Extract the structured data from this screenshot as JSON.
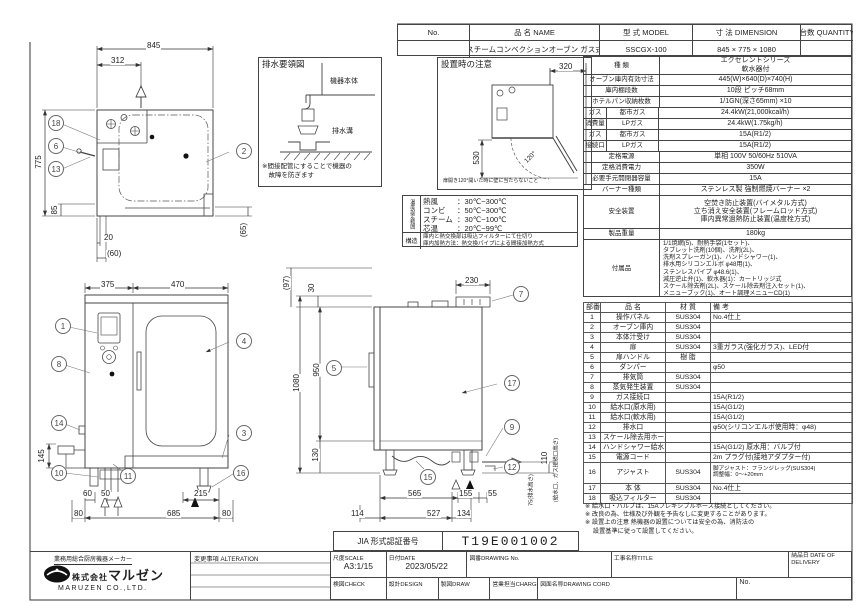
{
  "title_table": {
    "no_h": "No.",
    "name_h": "品 名 NAME",
    "model_h": "型 式 MODEL",
    "dim_h": "寸 法 DIMENSION",
    "qty_h": "台数 QUANTITY",
    "name": "スチームコンベクションオーブン ガス式",
    "model": "SSCGX-100",
    "dimension": "845 × 775 × 1080"
  },
  "spec": {
    "kind": {
      "label": "種  類",
      "v1": "エクセレントシリーズ",
      "v2": "軟水器付"
    },
    "cavity": {
      "label": "オーブン庫内有効寸法",
      "v": "445(W)×640(D)×740(H)"
    },
    "shelf": {
      "label": "庫内棚段数",
      "v": "10段 ピッチ68mm"
    },
    "pan": {
      "label": "ホテルパン収納枚数",
      "v": "1/1GN(深さ65mm) ×10"
    },
    "gasuse": {
      "a": "ガス",
      "b": "消費量",
      "city": "都市ガス",
      "lp": "LPガス",
      "city_v": "24.4kW(21,000kcal/h)",
      "lp_v": "24.4kW(1.75kg/h)"
    },
    "gascon": {
      "a": "ガス",
      "b": "接続口",
      "city": "都市ガス",
      "lp": "LPガス",
      "city_v": "15A(R1/2)",
      "lp_v": "15A(R1/2)"
    },
    "power": {
      "label": "定格電源",
      "v": "単相 100V 50/60Hz 510VA"
    },
    "watt": {
      "label": "定格消費電力",
      "v": "350W"
    },
    "breaker": {
      "label": "必要手元開閉器容量",
      "v": "15A"
    },
    "burner": {
      "label": "バーナー種類",
      "v": "ステンレス製 強制燃焼バーナー ×2"
    },
    "safety": {
      "label": "安全装置",
      "l1": "空焚き防止装置(バイメタル方式)",
      "l2": "立ち消え安全装置(フレームロッド方式)",
      "l3": "庫内異常過熱防止装置(温度栓方式)"
    },
    "weight": {
      "label": "製品重量",
      "v": "180kg"
    },
    "acc": {
      "label": "付属品",
      "lines": [
        "1/1焼網(5)、耐熱手袋(1セット)、",
        "タブレット洗剤(10個)、洗剤(2L)、",
        "洗剤スプレーガン(1)、ハンドシャワー(1)、",
        "排水用シリコンエルボ φ48用(1)、",
        "ステンレスパイプ φ48.6(1)、",
        "減圧逆止弁(1)、軟水器(1)：カートリッジ式",
        "スケール除去剤(2L)、スケール除去剤注入セット(1)、",
        "メニューブック(1)、オート調理メニューCD(1)"
      ]
    }
  },
  "parts": {
    "h_no": "部番",
    "h_name": "品 名",
    "h_mat": "材 質",
    "h_note": "備 考",
    "rows": [
      [
        "1",
        "操作パネル",
        "SUS304",
        "No.4仕上"
      ],
      [
        "2",
        "オーブン庫内",
        "SUS304",
        ""
      ],
      [
        "3",
        "本体汁受け",
        "SUS304",
        ""
      ],
      [
        "4",
        "扉",
        "SUS304",
        "3重ガラス(強化ガラス)、LED付"
      ],
      [
        "5",
        "扉ハンドル",
        "樹 脂",
        ""
      ],
      [
        "6",
        "ダンパー",
        "",
        "φ50"
      ],
      [
        "7",
        "排気筒",
        "SUS304",
        ""
      ],
      [
        "8",
        "蒸気発生装置",
        "SUS304",
        ""
      ],
      [
        "9",
        "ガス接続口",
        "",
        "15A(R1/2)"
      ],
      [
        "10",
        "給水口(原水用)",
        "",
        "15A(G1/2)"
      ],
      [
        "11",
        "給水口(軟水用)",
        "",
        "15A(G1/2)"
      ],
      [
        "12",
        "排水口",
        "",
        "φ50(シリコンエルボ使用時：φ48)"
      ],
      [
        "13",
        "スケール除去用ホース",
        "",
        ""
      ],
      [
        "14",
        "ハンドシャワー給水口",
        "",
        "15A(G1/2) 原水用：バルブ付"
      ],
      [
        "15",
        "電源コード",
        "",
        "2m プラグ付(接地アダプター付)"
      ],
      [
        "16",
        "アジャスト",
        "SUS304",
        "脚アジャスト：フランジレッグ(SUS304)\n調整幅：0〜+20mm"
      ],
      [
        "17",
        "本 体",
        "SUS304",
        "No.4仕上"
      ],
      [
        "18",
        "吸込フィルター",
        "SUS304",
        ""
      ]
    ]
  },
  "notes": [
    "※ 給水口・バルブは、15Aフレキシブルホース接続としてください。",
    "※ 改良の為、仕様及び外観を予告なしに変更することがあります。",
    "※ 設置上の注意 熱機器の設置については安全の為、消防法の",
    "　 設置基準に従って設置してください。"
  ],
  "jia": {
    "label": "JIA 形式認証番号",
    "number": "T19E001002"
  },
  "titleblock": {
    "scale_l": "尺度SCALE",
    "scale_v": "A3:1/15",
    "date_l": "日付DATE",
    "date_v": "2023/05/22",
    "dwgno_l": "図番DRAWING No.",
    "title_l": "工事名称TITLE",
    "delivery_l": "納品日 DATE OF DELIVERY",
    "check_l": "検図CHECK",
    "design_l": "設計DESIGN",
    "draw_l": "製図DRAW",
    "charge_l": "営業担当CHARGE",
    "cord_l": "図面名称DRAWING CORD",
    "no_l": "No.",
    "alteration_l": "変更事項 ALTERATION"
  },
  "company": {
    "tagline": "業務用総合厨房機器メーカー",
    "name_prefix": "株式会社",
    "name": "マルゼン",
    "name_en": "MARUZEN CO.,LTD."
  },
  "drain": {
    "title": "排水要領図",
    "body": "機器本体",
    "gutter": "排水溝",
    "note1": "※間接配管にすることで機器の",
    "note2": "　故障を防ぎます"
  },
  "install": {
    "title": "設置時の注意",
    "d320": "320",
    "d530": "530",
    "angle": "120°",
    "note": "扉開き120°開いた時に壁に当たらないこと"
  },
  "temp": {
    "header": "温度設定範囲",
    "rows": [
      {
        "l": "熱風",
        "v": "：30℃~300℃"
      },
      {
        "l": "コンビ",
        "v": "：50℃~300℃"
      },
      {
        "l": "スチーム",
        "v": "：30℃~100℃"
      },
      {
        "l": "芯温",
        "v": "：20℃~99℃"
      }
    ],
    "structure_l": "構造",
    "s1": "庫内と熱交換部は吸込フィルターにて仕切り",
    "s2": "庫内加熱方法：熱交換パイプによる間接加熱方式"
  },
  "plan": {
    "d845": "845",
    "d312": "312",
    "d775": "775",
    "d85": "85",
    "d20": "20",
    "d60": "(60)",
    "d65": "(65)",
    "b18": "18",
    "b6": "6",
    "b13": "13",
    "b2": "2"
  },
  "front": {
    "d375": "375",
    "d470": "470",
    "d145": "145",
    "d60": "60",
    "d50": "50",
    "d215": "215",
    "d80a": "80",
    "d685": "685",
    "d80b": "80",
    "b1": "1",
    "b8": "8",
    "b14": "14",
    "b10": "10",
    "b11": "11",
    "b4": "4",
    "b3": "3",
    "b16": "16"
  },
  "side": {
    "d97": "(97)",
    "d30": "30",
    "d230": "230",
    "d1080": "1080",
    "d950": "950",
    "d130": "130",
    "d565": "565",
    "d155": "155",
    "d55": "55",
    "d114": "114",
    "d527": "527",
    "d134": "134",
    "d110": "110",
    "d110note": "(給水口、ガス接続口高さ)",
    "d75": "75(排水高さ)",
    "b7": "7",
    "b5": "5",
    "b17": "17",
    "b9": "9",
    "b12": "12",
    "b15": "15"
  }
}
